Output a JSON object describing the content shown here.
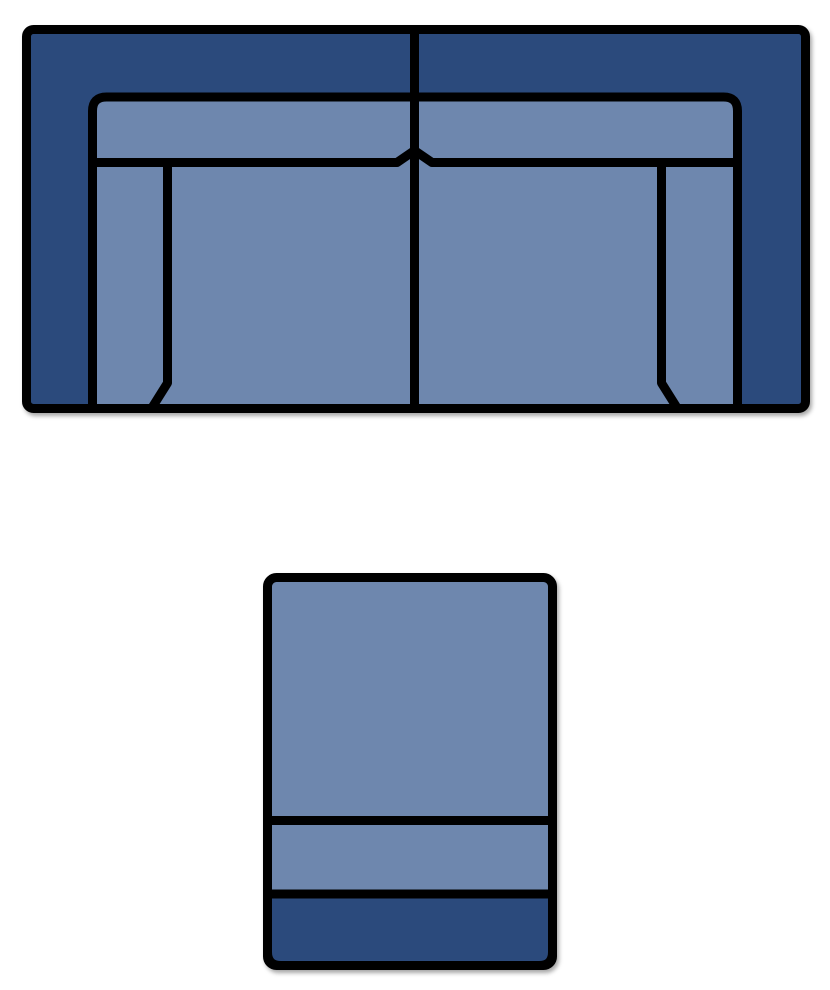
{
  "canvas": {
    "background": "#ffffff"
  },
  "colors": {
    "outline": "#000000",
    "frame_dark": "#2B4A7C",
    "cushion_light": "#6E87AE",
    "shadow": "rgba(0,0,0,0.35)"
  },
  "figures": {
    "sofa": {
      "name": "sofa-top-view",
      "parts": {
        "frame": "sofa-frame",
        "cushion_area": "sofa-cushion-area",
        "back_seam": "sofa-back-cushion-seam",
        "left_arm_seam": "sofa-left-arm-seam",
        "right_arm_seam": "sofa-right-arm-seam",
        "divider": "sofa-center-divider"
      }
    },
    "chair": {
      "name": "chair-top-view",
      "parts": {
        "body": "chair-body",
        "mid_seam": "chair-mid-seam",
        "base": "chair-base"
      }
    }
  }
}
